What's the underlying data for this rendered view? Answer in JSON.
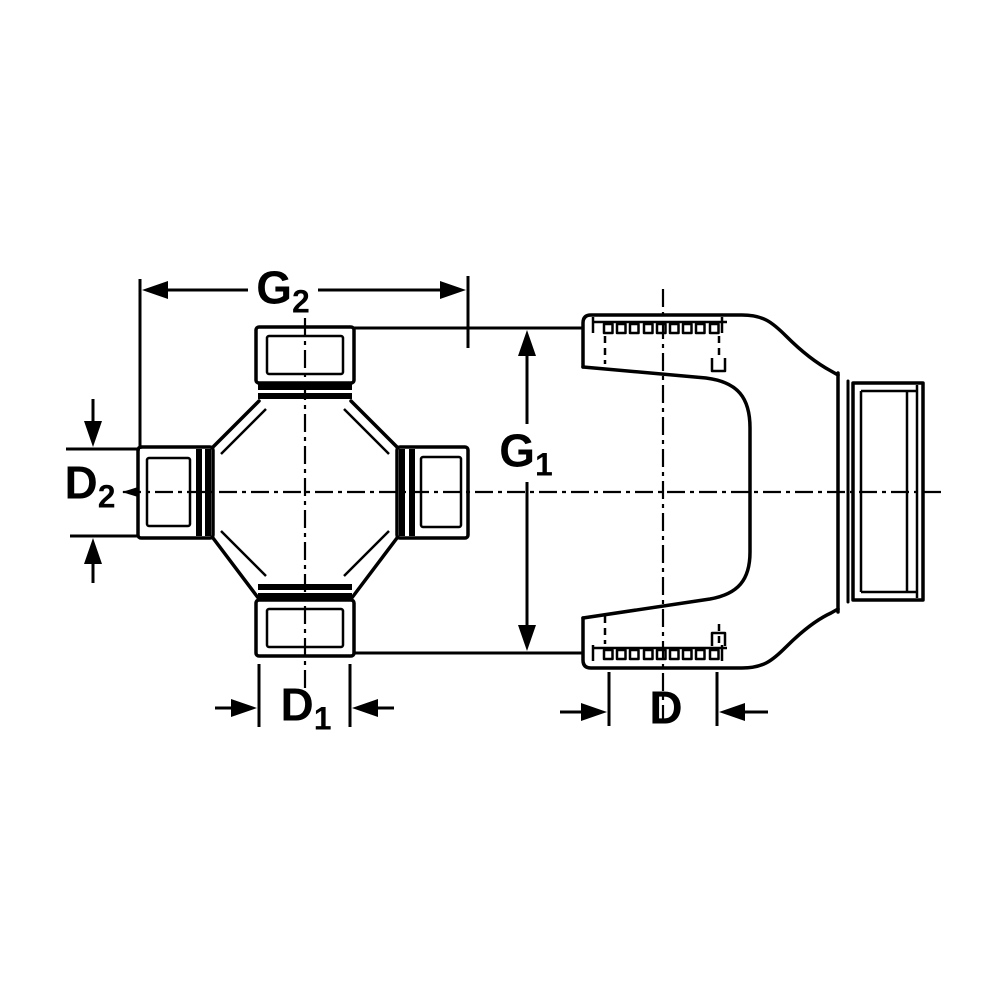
{
  "colors": {
    "line": "#000000",
    "background": "#ffffff"
  },
  "labels": {
    "g2": {
      "main": "G",
      "sub": "2"
    },
    "g1": {
      "main": "G",
      "sub": "1"
    },
    "d2": {
      "main": "D",
      "sub": "2"
    },
    "d1": {
      "main": "D",
      "sub": "1"
    },
    "d": {
      "main": "D",
      "sub": ""
    }
  }
}
